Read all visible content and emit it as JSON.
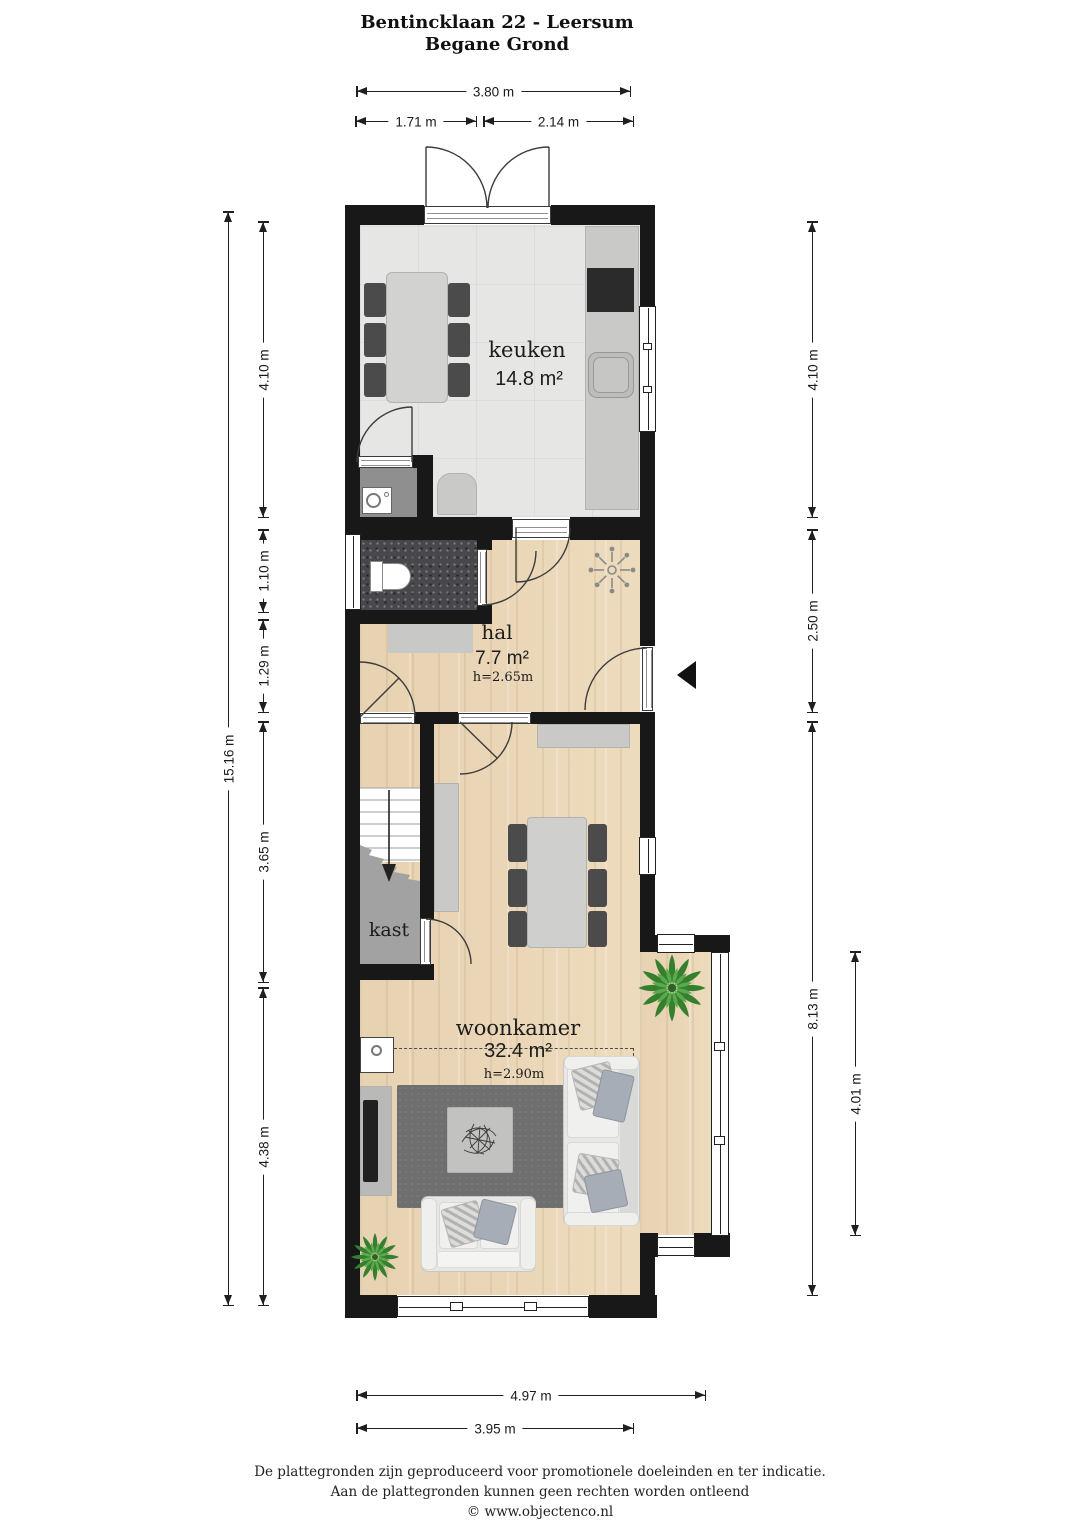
{
  "title": {
    "line1": "Bentincklaan 22 - Leersum",
    "line2": "Begane Grond"
  },
  "rooms": {
    "keuken": {
      "name": "keuken",
      "area": "14.8 m²"
    },
    "hal": {
      "name": "hal",
      "area": "7.7 m²",
      "ceiling": "h=2.65m"
    },
    "kast": {
      "name": "kast"
    },
    "woonkamer": {
      "name": "woonkamer",
      "area": "32.4 m²",
      "ceiling": "h=2.90m"
    }
  },
  "dims": {
    "top_total": "3.80 m",
    "top_left": "1.71 m",
    "top_right": "2.14 m",
    "left_total": "15.16 m",
    "left_1": "4.10 m",
    "left_2": "1.10 m",
    "left_3": "1.29 m",
    "left_4": "3.65 m",
    "left_5": "4.38 m",
    "right_1": "4.10 m",
    "right_2": "2.50 m",
    "right_3": "8.13 m",
    "right_bay": "4.01 m",
    "bottom_outer": "4.97 m",
    "bottom_inner": "3.95 m"
  },
  "footer": {
    "line1": "De plattegronden zijn geproduceerd voor promotionele doeleinden en ter indicatie.",
    "line2": "Aan de plattegronden kunnen geen rechten worden ontleend",
    "line3": "© www.objectenco.nl"
  },
  "icons": {
    "entrance_arrow": "◄",
    "radiator": "✳",
    "plant": "❃",
    "stairs_direction": "↓"
  },
  "colors": {
    "wall": "#181818",
    "wood_floor": "#ecd9ba",
    "tile_floor": "#e6e6e4",
    "toilet_floor": "#47474c",
    "closet_floor": "#a2a2a2",
    "rug": "#6f6f6f",
    "plant": "#357f2e",
    "dimension_text": "#1a1a1a"
  }
}
